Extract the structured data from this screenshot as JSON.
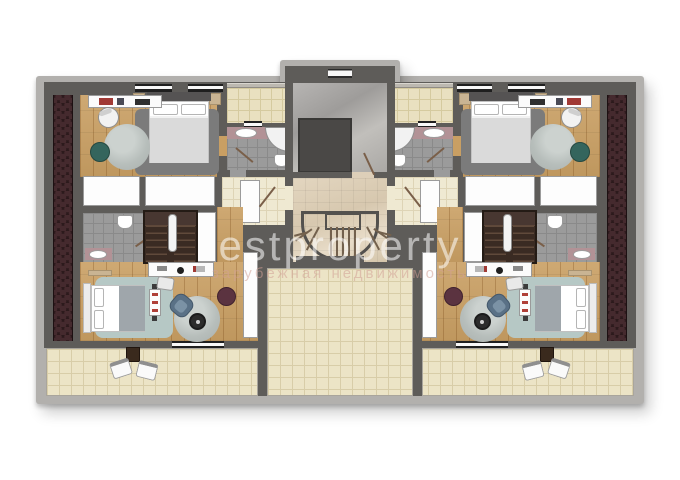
{
  "watermark": {
    "brand": "estproperty",
    "subtitle": "зарубежная недвижимость"
  },
  "palette": {
    "frame": "#b2b0ad",
    "wall": "#5e5c59",
    "wood": "#c99f63",
    "tile_beige": "#e9e0c0",
    "tile_beige_line": "#d5ca9f",
    "tile_terrace": "#ece4c6",
    "tile_terrace_line": "#d8cda8",
    "tile_gray": "#9b9b9b",
    "tile_gray_line": "#8a8a8a",
    "tile_cream": "#efe9d2",
    "tile_cream_line": "#ded4b6",
    "counter_mauve": "#b29296",
    "roof_base": "#2c1a1c",
    "roof_scale": "#452a2e",
    "shaft": "#4a4846",
    "stair_base": "#3a2b23",
    "stair_land": "#483731",
    "stair_line": "#604a3b",
    "rug_gray": "#7b7b7b",
    "rug_teal": "#b6c8c5",
    "pouf_teal": "#34655d",
    "pouf_burgundy": "#5b3340",
    "chair_blue": "#5a7186",
    "door_line": "#7a5f49",
    "window_dark": "#1f1f1f"
  }
}
